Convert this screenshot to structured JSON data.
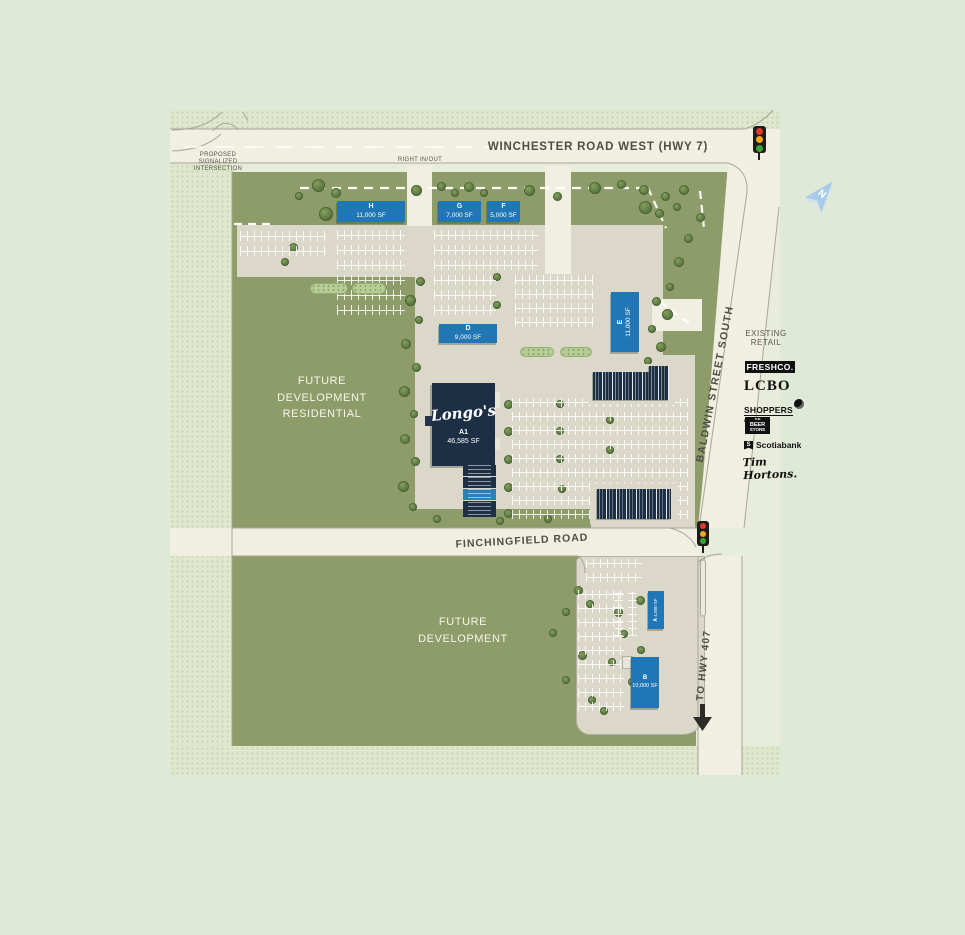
{
  "roads": {
    "winchester": "WINCHESTER ROAD WEST (HWY 7)",
    "baldwin": "BALDWIN STREET SOUTH",
    "finchingfield": "FINCHINGFIELD ROAD",
    "to_hwy_407": "TO HWY 407"
  },
  "annotations": {
    "proposed_intersection": "PROPOSED\nSIGNALIZED\nINTERSECTION",
    "right_in_out": "RIGHT IN/OUT",
    "north": "N"
  },
  "areas": {
    "future_residential": "FUTURE\nDEVELOPMENT\nRESIDENTIAL",
    "future_development": "FUTURE\nDEVELOPMENT"
  },
  "buildings": [
    {
      "id": "H",
      "size": "11,000 SF"
    },
    {
      "id": "G",
      "size": "7,000 SF"
    },
    {
      "id": "F",
      "size": "5,000 SF"
    },
    {
      "id": "D",
      "size": "9,000 SF"
    },
    {
      "id": "E",
      "size": "11,000 SF"
    },
    {
      "id": "A1",
      "tenant": "Longo's",
      "size": "46,585 SF"
    },
    {
      "id": "A",
      "size": "4,000 SF"
    },
    {
      "id": "B",
      "size": "10,000 SF"
    }
  ],
  "existing_retail": {
    "title": "EXISTING\nRETAIL",
    "logos": {
      "freshco": "FRESHCO.",
      "lcbo": "LCBO",
      "shoppers": "SHOPPERS",
      "shoppers_sub": "DRUG MART",
      "beer_the": "THE",
      "beer_beer": "BEER",
      "beer_store": "STORE",
      "scotiabank_s": "S",
      "scotiabank": "Scotiabank",
      "tim_hortons": "Tim Hortons."
    }
  },
  "colors": {
    "building_blue": "#2176b5",
    "anchor_navy": "#1c2f45",
    "site_green": "#8d9c68",
    "road_cream": "#f0efe1",
    "signal_red": "#e0392d",
    "signal_amber": "#f6a81c",
    "signal_green": "#3aa23a"
  }
}
